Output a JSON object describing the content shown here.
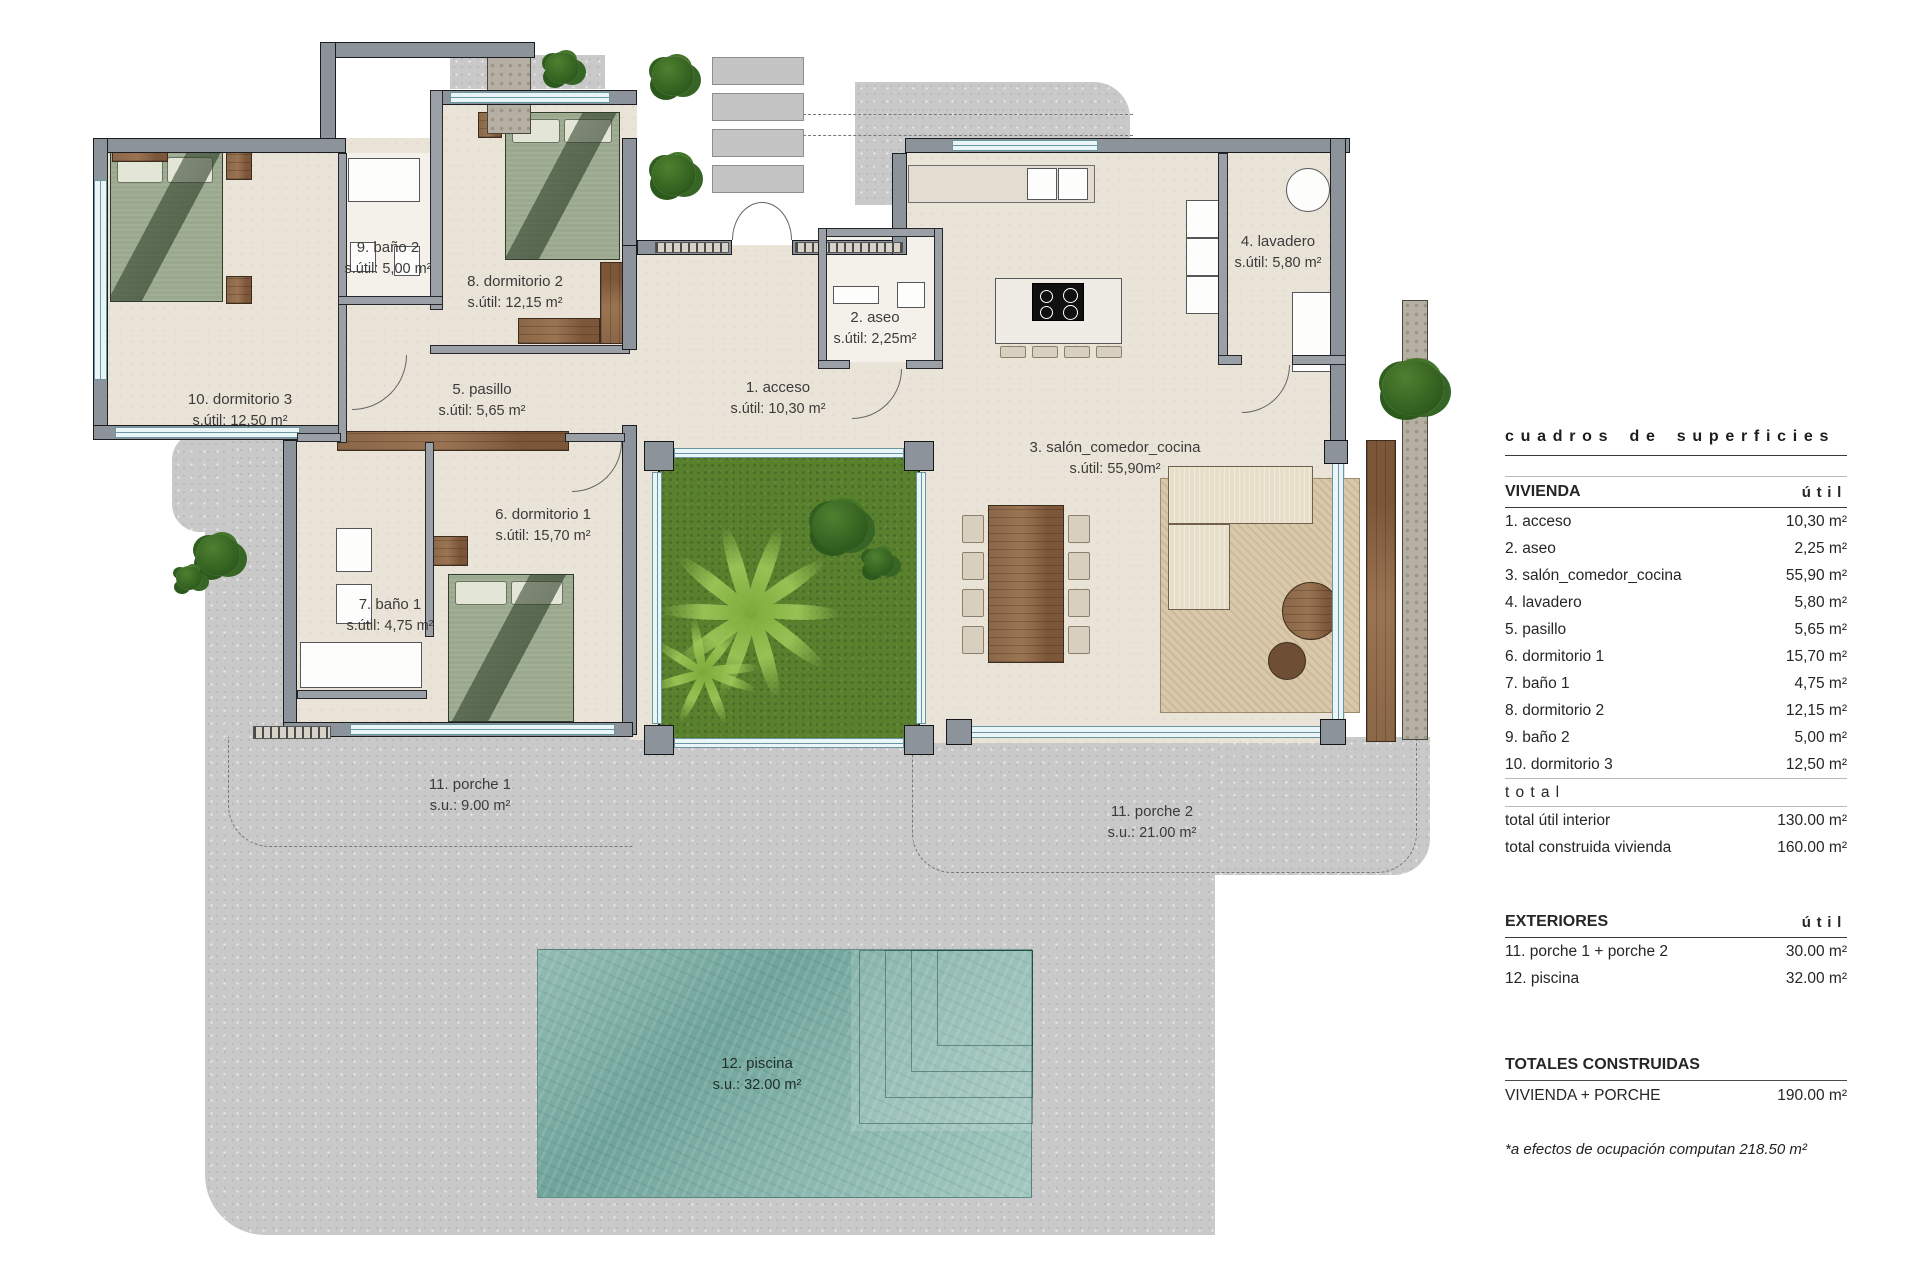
{
  "plan": {
    "labels": [
      {
        "name": "10. dormitorio 3",
        "area": "s.útil: 12,50 m²"
      },
      {
        "name": "9. baño 2",
        "area": "s.útil: 5,00 m²"
      },
      {
        "name": "8. dormitorio 2",
        "area": "s.útil: 12,15 m²"
      },
      {
        "name": "5. pasillo",
        "area": "s.útil: 5,65 m²"
      },
      {
        "name": "1. acceso",
        "area": "s.útil: 10,30 m²"
      },
      {
        "name": "2. aseo",
        "area": "s.útil: 2,25m²"
      },
      {
        "name": "4. lavadero",
        "area": "s.útil: 5,80 m²"
      },
      {
        "name": "3. salón_comedor_cocina",
        "area": "s.útil: 55,90m²"
      },
      {
        "name": "6. dormitorio 1",
        "area": "s.útil: 15,70 m²"
      },
      {
        "name": "7. baño 1",
        "area": "s.útil: 4,75 m²"
      },
      {
        "name": "11. porche 1",
        "area": "s.u.: 9.00 m²"
      },
      {
        "name": "11. porche 2",
        "area": "s.u.: 21.00 m²"
      },
      {
        "name": "12. piscina",
        "area": "s.u.: 32.00 m²"
      }
    ]
  },
  "panel": {
    "title": "cuadros de superficies",
    "vivienda": {
      "header": "VIVIENDA",
      "unit": "útil",
      "rows": [
        {
          "label": "1. acceso",
          "value": "10,30 m²"
        },
        {
          "label": "2. aseo",
          "value": "2,25 m²"
        },
        {
          "label": "3. salón_comedor_cocina",
          "value": "55,90 m²"
        },
        {
          "label": "4. lavadero",
          "value": "5,80 m²"
        },
        {
          "label": "5. pasillo",
          "value": "5,65 m²"
        },
        {
          "label": "6. dormitorio 1",
          "value": "15,70 m²"
        },
        {
          "label": "7. baño 1",
          "value": "4,75 m²"
        },
        {
          "label": "8. dormitorio 2",
          "value": "12,15 m²"
        },
        {
          "label": "9. baño 2",
          "value": "5,00 m²"
        },
        {
          "label": "10. dormitorio 3",
          "value": "12,50 m²"
        }
      ],
      "total_word": "total",
      "totals": [
        {
          "label": "total útil interior",
          "value": "130.00 m²"
        },
        {
          "label": "total construida vivienda",
          "value": "160.00 m²"
        }
      ]
    },
    "exteriores": {
      "header": "EXTERIORES",
      "unit": "útil",
      "rows": [
        {
          "label": "11. porche 1 + porche 2",
          "value": "30.00 m²"
        },
        {
          "label": "12. piscina",
          "value": "32.00 m²"
        }
      ]
    },
    "totales": {
      "header": "TOTALES CONSTRUIDAS",
      "rows": [
        {
          "label": "VIVIENDA + PORCHE",
          "value": "190.00 m²"
        }
      ]
    },
    "footnote": "*a efectos de ocupación computan 218.50 m²"
  },
  "colors": {
    "wall_gray": "#8d939a",
    "floor_beige": "#eae3d7",
    "terrain_gray": "#c9c9c9",
    "grass_green": "#59802d",
    "pool_teal": "#7fb0a7",
    "wood_brown": "#8a6748",
    "bed_green": "#9aa98e",
    "rug_tan": "#d9c8aa"
  }
}
